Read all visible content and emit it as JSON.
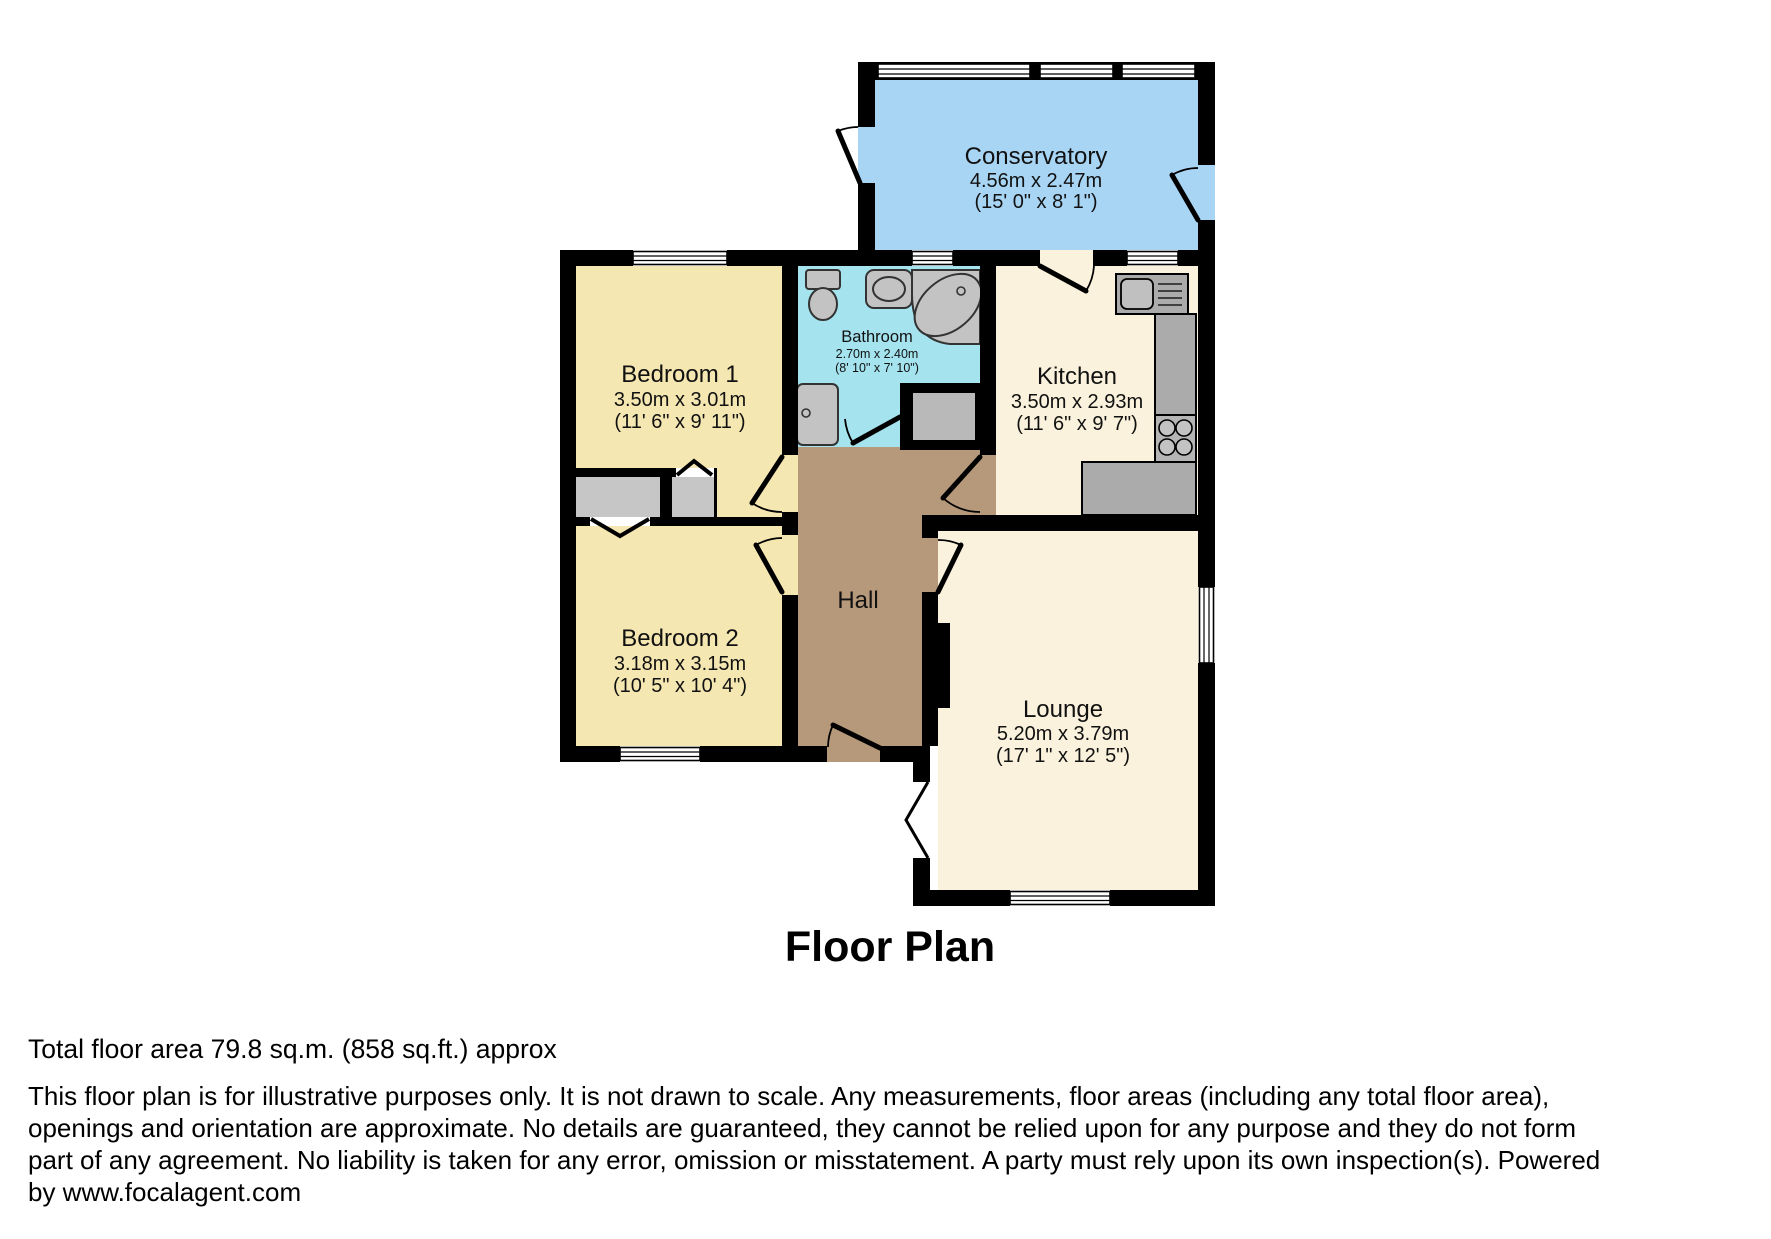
{
  "title": "Floor Plan",
  "rooms": {
    "conservatory": {
      "name": "Conservatory",
      "dims_m": "4.56m x 2.47m",
      "dims_ft": "(15' 0\" x 8' 1\")"
    },
    "bedroom1": {
      "name": "Bedroom 1",
      "dims_m": "3.50m x 3.01m",
      "dims_ft": "(11' 6\" x 9' 11\")"
    },
    "bathroom": {
      "name": "Bathroom",
      "dims_m": "2.70m x 2.40m",
      "dims_ft": "(8' 10\" x 7' 10\")"
    },
    "kitchen": {
      "name": "Kitchen",
      "dims_m": "3.50m x 2.93m",
      "dims_ft": "(11' 6\" x 9' 7\")"
    },
    "bedroom2": {
      "name": "Bedroom 2",
      "dims_m": "3.18m x 3.15m",
      "dims_ft": "(10' 5\" x 10' 4\")"
    },
    "hall": {
      "name": "Hall"
    },
    "lounge": {
      "name": "Lounge",
      "dims_m": "5.20m x 3.79m",
      "dims_ft": "(17' 1\" x 12' 5\")"
    }
  },
  "colors": {
    "conservatory": "#a9d5f5",
    "bathroom": "#a5e4ef",
    "bedroom": "#f5e7b2",
    "kitchen_lounge": "#faf2dc",
    "hall": "#b6997a",
    "wall": "#000000"
  },
  "footer": {
    "total_area": "Total floor area 79.8 sq.m. (858 sq.ft.) approx",
    "disclaimer_lines": [
      "This floor plan is for illustrative purposes only. It is not drawn to scale. Any measurements, floor areas (including any total floor area),",
      "openings and orientation are approximate. No details are guaranteed, they cannot be relied upon for any purpose and they do not form",
      "part of any agreement. No liability is taken for any error, omission or misstatement. A party must rely upon its own inspection(s). Powered",
      "by www.focalagent.com"
    ]
  }
}
